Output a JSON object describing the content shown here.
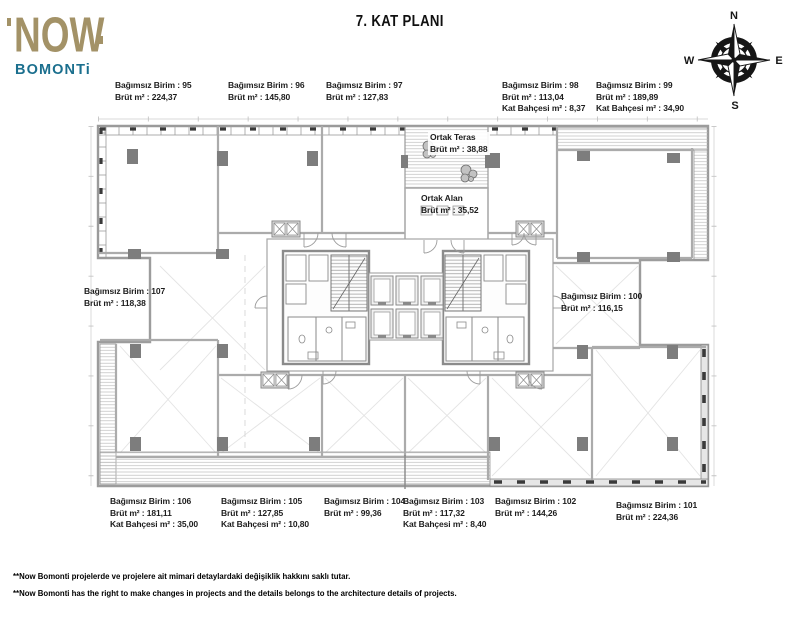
{
  "header": {
    "logo": {
      "top": "NOW",
      "bottom": "BOMONTi"
    },
    "title": "7. KAT PLANI",
    "compass": {
      "n": "N",
      "e": "E",
      "s": "S",
      "w": "W"
    }
  },
  "common": {
    "teras": {
      "name": "Ortak Teras",
      "brut": "Brüt m² : 38,88"
    },
    "alan": {
      "name": "Ortak Alan",
      "brut": "Brüt m² : 35,52"
    }
  },
  "units": {
    "u95": {
      "name": "Bağımsız Birim : 95",
      "brut": "Brüt m² : 224,37"
    },
    "u96": {
      "name": "Bağımsız Birim : 96",
      "brut": "Brüt m² : 145,80"
    },
    "u97": {
      "name": "Bağımsız Birim : 97",
      "brut": "Brüt m² : 127,83"
    },
    "u98": {
      "name": "Bağımsız Birim : 98",
      "brut": "Brüt m² : 113,04",
      "garden": "Kat Bahçesi m² : 8,37"
    },
    "u99": {
      "name": "Bağımsız Birim : 99",
      "brut": "Brüt m² : 189,89",
      "garden": "Kat Bahçesi m² : 34,90"
    },
    "u100": {
      "name": "Bağımsız Birim : 100",
      "brut": "Brüt m² : 116,15"
    },
    "u101": {
      "name": "Bağımsız Birim : 101",
      "brut": "Brüt m² : 224,36"
    },
    "u102": {
      "name": "Bağımsız Birim : 102",
      "brut": "Brüt m² : 144,26"
    },
    "u103": {
      "name": "Bağımsız Birim : 103",
      "brut": "Brüt m² : 117,32",
      "garden": "Kat Bahçesi m² : 8,40"
    },
    "u104": {
      "name": "Bağımsız Birim : 104",
      "brut": "Brüt m² : 99,36"
    },
    "u105": {
      "name": "Bağımsız Birim : 105",
      "brut": "Brüt m² : 127,85",
      "garden": "Kat Bahçesi m² : 10,80"
    },
    "u106": {
      "name": "Bağımsız Birim : 106",
      "brut": "Brüt m² : 181,11",
      "garden": "Kat Bahçesi m² : 35,00"
    },
    "u107": {
      "name": "Bağımsız Birim : 107",
      "brut": "Brüt m² : 118,38"
    }
  },
  "footer": {
    "tr": "**Now Bomonti projelerde ve projelere ait mimari detaylardaki değişiklik hakkını saklı tutar.",
    "en": "**Now Bomonti has the right to make changes in projects and the details belongs to the architecture details of projects."
  },
  "colors": {
    "logo_tan": "#a39267",
    "logo_teal": "#1b6f8e",
    "wall_gray": "#9c9c9c"
  }
}
